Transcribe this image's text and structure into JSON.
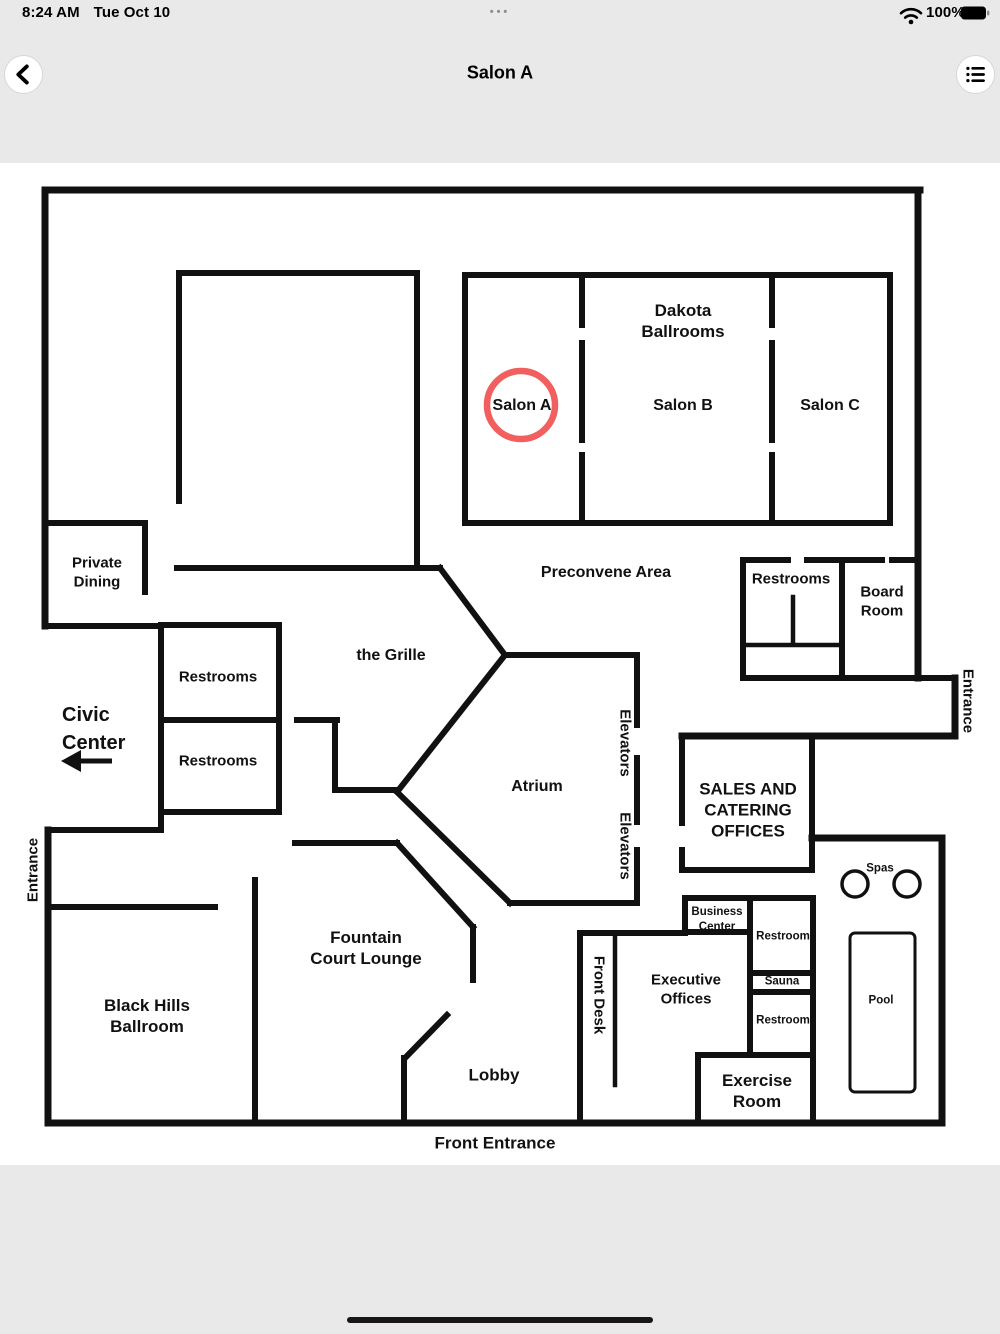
{
  "status_bar": {
    "time": "8:24 AM",
    "date": "Tue Oct 10",
    "battery_level": "100%",
    "more_dots": "•••"
  },
  "nav_bar": {
    "title": "Salon A"
  },
  "icons": {
    "back": "chevron-left-icon",
    "menu": "list-menu-icon",
    "wifi": "wifi-icon",
    "battery": "battery-full-icon",
    "more": "ellipsis-icon"
  },
  "colors": {
    "bg": "#e9e9e9",
    "surface": "#ffffff",
    "wall": "#111111",
    "accent": "#f15f5f",
    "muted": "#8e8e93"
  },
  "map": {
    "highlight": {
      "room": "Salon A",
      "shape": "circle"
    },
    "labels": {
      "dakota": "Dakota\nBallrooms",
      "salon_a": "Salon A",
      "salon_b": "Salon B",
      "salon_c": "Salon C",
      "private_dining": "Private\nDining",
      "preconvene": "Preconvene Area",
      "restrooms_ne": "Restrooms",
      "board_room": "Board\nRoom",
      "entrance_right": "Entrance",
      "grille": "the Grille",
      "restrooms_w1": "Restrooms",
      "restrooms_w2": "Restrooms",
      "civic_center": "Civic\nCenter",
      "elevators_1": "Elevators",
      "elevators_2": "Elevators",
      "atrium": "Atrium",
      "sales": "SALES AND\nCATERING\nOFFICES",
      "entrance_left": "Entrance",
      "spas": "Spas",
      "business_center": "Business\nCenter",
      "restroom_1": "Restroom",
      "sauna": "Sauna",
      "restroom_2": "Restroom",
      "pool": "Pool",
      "executive": "Executive\nOffices",
      "front_desk": "Front Desk",
      "fountain": "Fountain\nCourt Lounge",
      "black_hills": "Black Hills\nBallroom",
      "lobby": "Lobby",
      "exercise": "Exercise\nRoom",
      "front_entrance": "Front Entrance"
    }
  }
}
